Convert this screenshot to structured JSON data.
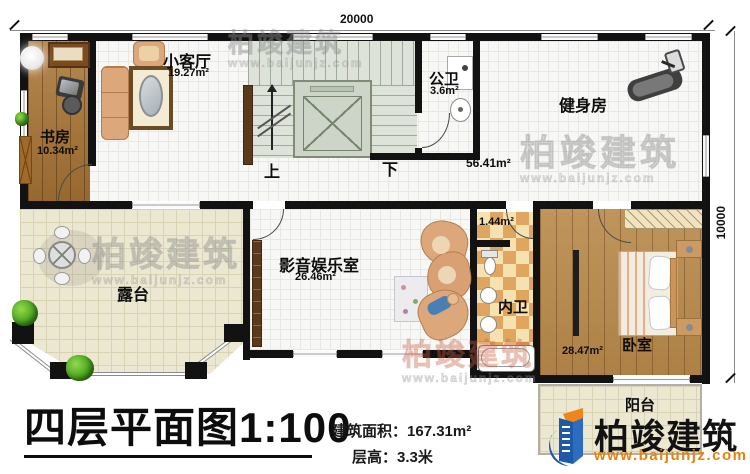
{
  "dimensions": {
    "top": "20000",
    "right": "10000"
  },
  "rooms": {
    "study": {
      "name": "书房",
      "area": "10.34m²"
    },
    "small_living": {
      "name": "小客厅",
      "area": "19.27m²"
    },
    "public_bath": {
      "name": "公卫",
      "area": "3.6m²"
    },
    "gym": {
      "name": "健身房",
      "area": "56.41m²"
    },
    "terrace": {
      "name": "露台"
    },
    "media_room": {
      "name": "影音娱乐室",
      "area": "26.46m²"
    },
    "vestibule": {
      "area": "1.44m²"
    },
    "inner_bath": {
      "name": "内卫"
    },
    "bedroom": {
      "name": "卧室",
      "area": "28.47m²"
    },
    "balcony": {
      "name": "阳台"
    }
  },
  "stairs": {
    "up_label": "上",
    "down_label": "下"
  },
  "footer": {
    "plan_title": "四层平面图",
    "scale": "1:100",
    "area_label": "建筑面积：",
    "area_value": "167.31m²",
    "floor_height_label": "层高：",
    "floor_height_value": "3.3米"
  },
  "logo": {
    "brand": "柏竣建筑",
    "url": "www.baijunjz.com"
  },
  "watermark": {
    "brand": "柏竣建筑",
    "url": "www.baijunjz.com"
  },
  "colors": {
    "brand_blue": "#1d59a8",
    "brand_orange": "#f08519",
    "url_orange": "#e8820c",
    "wall": "#121212"
  }
}
